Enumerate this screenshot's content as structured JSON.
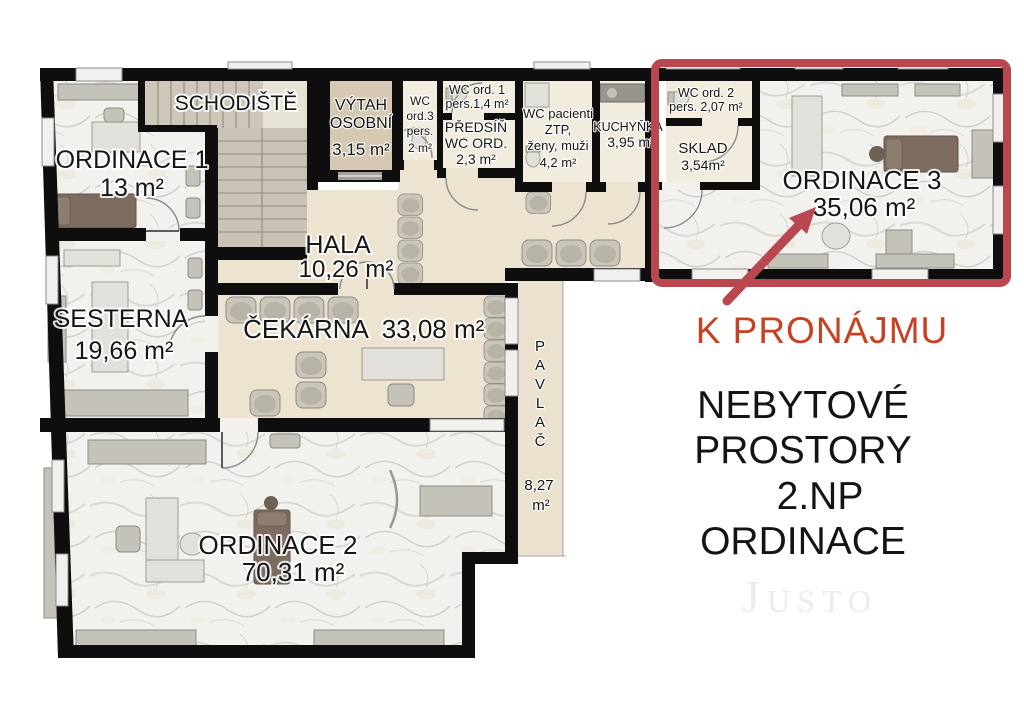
{
  "plan": {
    "rooms": {
      "schodiste": {
        "label": "SCHODIŠTĚ"
      },
      "ordinace1": {
        "label": "ORDINACE 1",
        "area": "13 m²"
      },
      "vytah": {
        "line1": "VÝTAH",
        "line2": "OSOBNÍ",
        "area": "3,15 m²"
      },
      "wc_ord3": {
        "line1": "WC",
        "line2": "ord.3",
        "line3": "pers.",
        "line4": "2 m²"
      },
      "wc_ord1": {
        "line1": "WC ord. 1",
        "line2": "pers.1,4 m²"
      },
      "predsin": {
        "line1": "PŘEDSÍŇ",
        "line2": "WC ORD.",
        "line3": "2,3 m²"
      },
      "wc_pacienti": {
        "line1": "WC pacienti",
        "line2": "ZTP,",
        "line3": "ženy, muži",
        "line4": "4,2 m²"
      },
      "kuchynka": {
        "label": "KUCHYŇKA",
        "area": "3,95 m²"
      },
      "wc_ord2": {
        "line1": "WC ord. 2",
        "line2": "pers. 2,07 m²"
      },
      "sklad": {
        "label": "SKLAD",
        "area": "3,54m²"
      },
      "ordinace3": {
        "label": "ORDINACE 3",
        "area": "35,06 m²"
      },
      "hala": {
        "label": "HALA",
        "area": "10,26 m²"
      },
      "cekarna": {
        "label": "ČEKÁRNA",
        "area": "33,08 m²"
      },
      "sesterna": {
        "label": "SESTERNA",
        "area": "19,66 m²"
      },
      "pavlac": {
        "letters": [
          "P",
          "A",
          "V",
          "L",
          "A",
          "Č"
        ],
        "area_line1": "8,27",
        "area_line2": "m²"
      },
      "ordinace2": {
        "label": "ORDINACE 2",
        "area": "70,31 m²"
      }
    }
  },
  "annotations": {
    "for_rent": "K PRONÁJMU",
    "title_lines": [
      "NEBYTOVÉ",
      "PROSTORY",
      "2.NP",
      "ORDINACE"
    ],
    "watermark": "Justo"
  },
  "colors": {
    "highlight_red": "#b8474f",
    "for_rent_orange": "#c64222",
    "wall_black": "#0e0e0e",
    "floor_cream": "#ece4d1",
    "wc_cream": "#f2ecdf",
    "elevator_tan": "#d6c9b4",
    "marble_light": "#f2f1ee",
    "watermark_gray": "#edece8"
  }
}
